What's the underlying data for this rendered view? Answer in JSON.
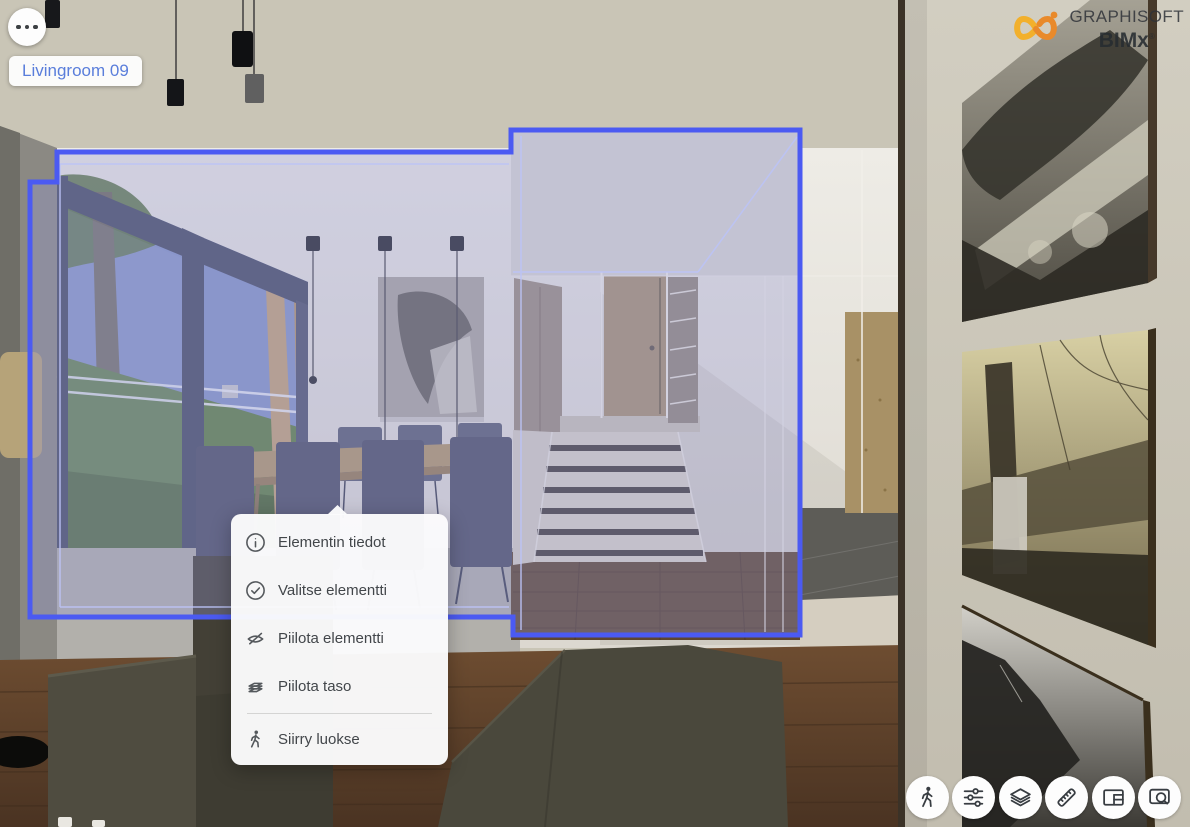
{
  "header": {
    "room_tag": "Livingroom 09",
    "brand": {
      "name": "GRAPHISOFT",
      "product": "BIMx",
      "registered": "®",
      "logo_icon": "infinity-logo-icon",
      "logo_yellow": "#f2b02c",
      "logo_orange": "#e98a2b"
    },
    "more_button_icon": "ellipsis-icon"
  },
  "context_menu": {
    "items": [
      {
        "label": "Elementin tiedot",
        "icon": "info-icon"
      },
      {
        "label": "Valitse elementti",
        "icon": "check-circle-icon"
      },
      {
        "label": "Piilota elementti",
        "icon": "eye-off-icon"
      },
      {
        "label": "Piilota taso",
        "icon": "layers-icon"
      },
      {
        "label": "Siirry luokse",
        "icon": "walk-icon"
      }
    ]
  },
  "toolbar": {
    "buttons": [
      {
        "name": "walk-mode",
        "icon": "walk-icon"
      },
      {
        "name": "settings",
        "icon": "sliders-icon"
      },
      {
        "name": "layers",
        "icon": "layer-stack-icon"
      },
      {
        "name": "measure",
        "icon": "ruler-icon"
      },
      {
        "name": "views-panel",
        "icon": "layout-panel-icon"
      },
      {
        "name": "zoom-extent",
        "icon": "zoom-window-icon"
      }
    ]
  },
  "selection": {
    "selected_room": "Livingroom 09",
    "outline_color": "#4b5af2",
    "fill_color": "rgba(148,152,214,0.33)"
  }
}
